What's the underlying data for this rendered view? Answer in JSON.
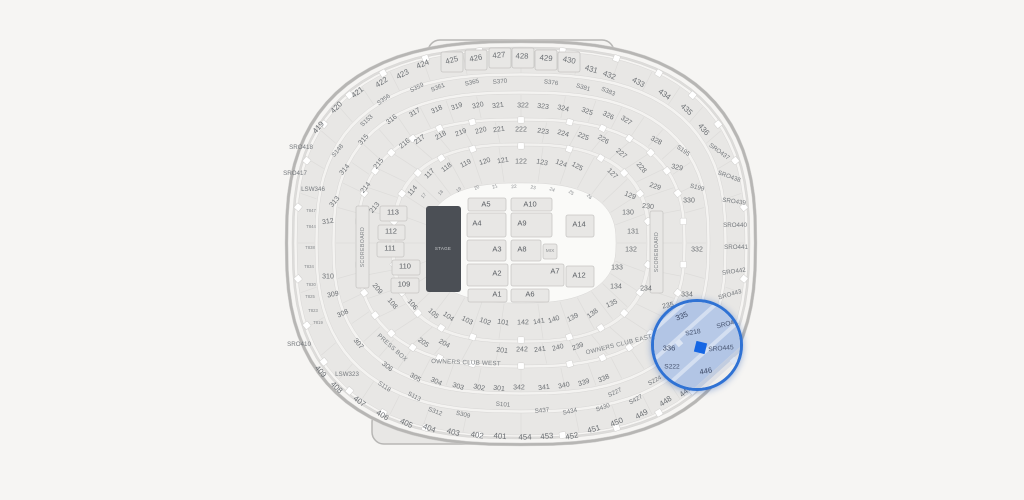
{
  "app": {
    "title": "Stadium seat map"
  },
  "colors": {
    "background": "#f6f5f3",
    "bowl": "#e8e7e5",
    "walkway": "#f4f3f1",
    "rim": "#b7b6b4",
    "section_line": "#dddcda",
    "box_stroke": "#c7c6c4",
    "floor": "#fafaf8",
    "stage_fill": "#4b4f55",
    "magnifier_ring": "#2f72d4",
    "magnifier_fill": "#b2c5e5",
    "selected": "#1566e4"
  },
  "map": {
    "labels": [
      [
        "419",
        319,
        128,
        "b"
      ],
      [
        "420",
        337,
        108,
        "b"
      ],
      [
        "421",
        358,
        93,
        "b"
      ],
      [
        "422",
        382,
        83,
        "b"
      ],
      [
        "423",
        403,
        75,
        "b"
      ],
      [
        "424",
        423,
        65,
        "b"
      ],
      [
        "425",
        452,
        61,
        "b"
      ],
      [
        "426",
        476,
        59,
        "b"
      ],
      [
        "427",
        499,
        56,
        "b"
      ],
      [
        "428",
        522,
        57,
        "b"
      ],
      [
        "429",
        546,
        59,
        "b"
      ],
      [
        "430",
        569,
        61,
        "b"
      ],
      [
        "431",
        591,
        70,
        "b"
      ],
      [
        "432",
        609,
        76,
        "b"
      ],
      [
        "433",
        638,
        83,
        "b"
      ],
      [
        "434",
        664,
        95,
        "b"
      ],
      [
        "435",
        686,
        110,
        "b"
      ],
      [
        "436",
        703,
        130,
        "b"
      ],
      [
        "409",
        320,
        372,
        "b"
      ],
      [
        "408",
        336,
        388,
        "b"
      ],
      [
        "407",
        359,
        402,
        "b"
      ],
      [
        "406",
        382,
        416,
        "b"
      ],
      [
        "405",
        406,
        424,
        "b"
      ],
      [
        "404",
        429,
        429,
        "b"
      ],
      [
        "403",
        453,
        433,
        "b"
      ],
      [
        "402",
        477,
        436,
        "b"
      ],
      [
        "401",
        500,
        437,
        "b"
      ],
      [
        "454",
        525,
        438,
        "b"
      ],
      [
        "453",
        547,
        437,
        "b"
      ],
      [
        "452",
        572,
        437,
        "b"
      ],
      [
        "451",
        594,
        430,
        "b"
      ],
      [
        "450",
        617,
        423,
        "b"
      ],
      [
        "449",
        642,
        415,
        "b"
      ],
      [
        "448",
        666,
        402,
        "b"
      ],
      [
        "447",
        686,
        392,
        "b"
      ],
      [
        "SRO418",
        301,
        148,
        "s",
        0
      ],
      [
        "SRO417",
        295,
        174,
        "s",
        0
      ],
      [
        "SRO410",
        299,
        345,
        "s",
        0
      ],
      [
        "LSW346",
        313,
        190,
        "s",
        0
      ],
      [
        "LSW323",
        347,
        375,
        "s",
        0
      ],
      [
        "SRO437",
        719,
        152,
        "s",
        36
      ],
      [
        "SRO438",
        729,
        177,
        "s",
        20
      ],
      [
        "SRO439",
        734,
        202,
        "s",
        8
      ],
      [
        "SRO440",
        735,
        226,
        "s",
        0
      ],
      [
        "SRO441",
        736,
        248,
        "s",
        0
      ],
      [
        "SRO442",
        734,
        272,
        "s",
        -8
      ],
      [
        "SRO443",
        730,
        295,
        "s",
        -16
      ],
      [
        "S356",
        384,
        100,
        "s"
      ],
      [
        "S359",
        417,
        88,
        "s"
      ],
      [
        "S361",
        438,
        88,
        "s"
      ],
      [
        "S365",
        472,
        83,
        "s"
      ],
      [
        "S370",
        500,
        82,
        "s"
      ],
      [
        "S376",
        551,
        83,
        "s"
      ],
      [
        "S381",
        583,
        88,
        "s"
      ],
      [
        "S383",
        608,
        92,
        "s"
      ],
      [
        "S153",
        367,
        121,
        "s"
      ],
      [
        "S148",
        338,
        151,
        "s"
      ],
      [
        "S195",
        683,
        151,
        "s",
        35
      ],
      [
        "S199",
        697,
        188,
        "s",
        15
      ],
      [
        "S118",
        384,
        387,
        "s"
      ],
      [
        "S113",
        414,
        397,
        "s"
      ],
      [
        "S101",
        503,
        405,
        "s"
      ],
      [
        "S312",
        435,
        412,
        "s"
      ],
      [
        "S309",
        463,
        415,
        "s"
      ],
      [
        "S437",
        542,
        411,
        "s"
      ],
      [
        "S434",
        570,
        412,
        "s"
      ],
      [
        "S430",
        603,
        408,
        "s"
      ],
      [
        "S427",
        636,
        400,
        "s"
      ],
      [
        "S227",
        615,
        393,
        "s"
      ],
      [
        "S224",
        655,
        381,
        "s",
        -28
      ],
      [
        "316",
        392,
        120
      ],
      [
        "317",
        415,
        113
      ],
      [
        "318",
        437,
        110
      ],
      [
        "319",
        457,
        107
      ],
      [
        "320",
        478,
        106
      ],
      [
        "321",
        498,
        106
      ],
      [
        "322",
        523,
        106
      ],
      [
        "323",
        543,
        107
      ],
      [
        "324",
        563,
        109
      ],
      [
        "325",
        587,
        112
      ],
      [
        "326",
        608,
        116
      ],
      [
        "327",
        626,
        121
      ],
      [
        "328",
        656,
        141,
        "",
        28
      ],
      [
        "329",
        677,
        168,
        "",
        12
      ],
      [
        "330",
        689,
        201,
        "",
        0
      ],
      [
        "332",
        697,
        250,
        "",
        0
      ],
      [
        "334",
        687,
        295,
        "",
        0
      ],
      [
        "315",
        364,
        140
      ],
      [
        "314",
        345,
        170
      ],
      [
        "313",
        335,
        202
      ],
      [
        "312",
        328,
        222,
        "",
        -8
      ],
      [
        "310",
        328,
        277,
        "",
        0
      ],
      [
        "309",
        333,
        295,
        "",
        -12
      ],
      [
        "308",
        343,
        314,
        "",
        -25
      ],
      [
        "307",
        358,
        344
      ],
      [
        "306",
        387,
        367
      ],
      [
        "305",
        415,
        378
      ],
      [
        "304",
        436,
        382
      ],
      [
        "303",
        458,
        387
      ],
      [
        "302",
        479,
        388
      ],
      [
        "301",
        499,
        389
      ],
      [
        "342",
        519,
        388
      ],
      [
        "341",
        544,
        388
      ],
      [
        "340",
        564,
        386
      ],
      [
        "339",
        584,
        383
      ],
      [
        "338",
        604,
        379
      ],
      [
        "215",
        379,
        164
      ],
      [
        "216",
        405,
        144
      ],
      [
        "217",
        420,
        140
      ],
      [
        "218",
        441,
        136
      ],
      [
        "219",
        461,
        133
      ],
      [
        "220",
        481,
        131
      ],
      [
        "221",
        499,
        130
      ],
      [
        "222",
        521,
        130
      ],
      [
        "223",
        543,
        132
      ],
      [
        "224",
        563,
        134
      ],
      [
        "225",
        583,
        137
      ],
      [
        "226",
        603,
        140
      ],
      [
        "227",
        621,
        154
      ],
      [
        "228",
        641,
        168
      ],
      [
        "229",
        655,
        187,
        "",
        18
      ],
      [
        "230",
        648,
        207,
        "",
        5
      ],
      [
        "214",
        366,
        188
      ],
      [
        "213",
        375,
        208
      ],
      [
        "209",
        377,
        289
      ],
      [
        "205",
        423,
        343
      ],
      [
        "204",
        444,
        344
      ],
      [
        "201",
        502,
        351
      ],
      [
        "242",
        522,
        350
      ],
      [
        "241",
        540,
        350
      ],
      [
        "240",
        558,
        348
      ],
      [
        "239",
        578,
        347
      ],
      [
        "234",
        646,
        289,
        "",
        0
      ],
      [
        "235",
        668,
        306,
        "",
        -12
      ],
      [
        "114",
        413,
        191
      ],
      [
        "117",
        430,
        174
      ],
      [
        "118",
        447,
        168
      ],
      [
        "119",
        466,
        164
      ],
      [
        "120",
        485,
        162
      ],
      [
        "121",
        503,
        161
      ],
      [
        "122",
        521,
        162
      ],
      [
        "123",
        542,
        163
      ],
      [
        "124",
        561,
        164
      ],
      [
        "125",
        577,
        167
      ],
      [
        "127",
        612,
        174
      ],
      [
        "129",
        630,
        196,
        "",
        22
      ],
      [
        "130",
        628,
        213,
        "",
        0
      ],
      [
        "131",
        633,
        232,
        "",
        0
      ],
      [
        "132",
        631,
        250,
        "",
        0
      ],
      [
        "133",
        617,
        268,
        "",
        0
      ],
      [
        "134",
        616,
        287,
        "",
        0
      ],
      [
        "135",
        612,
        304,
        "",
        -25
      ],
      [
        "138",
        593,
        314
      ],
      [
        "139",
        573,
        318
      ],
      [
        "140",
        554,
        320
      ],
      [
        "141",
        539,
        322
      ],
      [
        "142",
        523,
        323
      ],
      [
        "101",
        503,
        323
      ],
      [
        "102",
        485,
        322
      ],
      [
        "103",
        467,
        321
      ],
      [
        "104",
        448,
        317
      ],
      [
        "105",
        433,
        314
      ],
      [
        "106",
        412,
        305
      ],
      [
        "108",
        392,
        304
      ],
      [
        "17",
        424,
        196,
        "tiny"
      ],
      [
        "18",
        441,
        193,
        "tiny"
      ],
      [
        "19",
        459,
        190,
        "tiny"
      ],
      [
        "20",
        477,
        188,
        "tiny"
      ],
      [
        "21",
        495,
        187,
        "tiny"
      ],
      [
        "22",
        514,
        187,
        "tiny"
      ],
      [
        "23",
        533,
        188,
        "tiny"
      ],
      [
        "24",
        552,
        190,
        "tiny"
      ],
      [
        "25",
        571,
        193,
        "tiny"
      ],
      [
        "26",
        589,
        197,
        "tiny"
      ],
      [
        "T847",
        311,
        211,
        "t",
        0
      ],
      [
        "T844",
        311,
        227,
        "t",
        0
      ],
      [
        "T838",
        310,
        248,
        "t",
        0
      ],
      [
        "T834",
        309,
        267,
        "t",
        0
      ],
      [
        "T830",
        311,
        285,
        "t",
        0
      ],
      [
        "T825",
        310,
        297,
        "t",
        0
      ],
      [
        "T823",
        313,
        311,
        "t",
        0
      ],
      [
        "T819",
        318,
        323,
        "t",
        0
      ]
    ],
    "special_labels": [
      [
        "PRESS BOX",
        392,
        348,
        "area",
        42
      ],
      [
        "OWNERS CLUB WEST",
        466,
        363,
        "area",
        2
      ],
      [
        "OWNERS CLUB EAST",
        619,
        345,
        "area",
        -14
      ],
      [
        "SCOREBOARD",
        363,
        247,
        "sb",
        -90
      ],
      [
        "SCOREBOARD",
        657,
        252,
        "sb",
        -90
      ],
      [
        "STAGE",
        443,
        249,
        "stage",
        0
      ]
    ],
    "floor_sections": [
      [
        "A5",
        468,
        198,
        38,
        13,
        486,
        205
      ],
      [
        "A10",
        511,
        198,
        41,
        13,
        530,
        205
      ],
      [
        "A4",
        467,
        213,
        39,
        24,
        477,
        224
      ],
      [
        "A9",
        511,
        213,
        41,
        24,
        522,
        224
      ],
      [
        "A14",
        566,
        215,
        28,
        22,
        579,
        225
      ],
      [
        "A3",
        467,
        240,
        39,
        21,
        497,
        250
      ],
      [
        "A8",
        511,
        240,
        30,
        21,
        522,
        250
      ],
      [
        "MIX",
        543,
        244,
        14,
        15,
        550,
        251
      ],
      [
        "A2",
        467,
        264,
        41,
        22,
        497,
        274
      ],
      [
        "A7",
        511,
        264,
        53,
        22,
        555,
        272
      ],
      [
        "A12",
        566,
        266,
        28,
        21,
        579,
        276
      ],
      [
        "A1",
        468,
        289,
        39,
        13,
        497,
        295
      ],
      [
        "A6",
        511,
        289,
        38,
        13,
        530,
        295
      ]
    ],
    "side_boxes": [
      [
        "113",
        380,
        206,
        27,
        15,
        393,
        213
      ],
      [
        "112",
        378,
        225,
        27,
        15,
        391,
        232
      ],
      [
        "111",
        377,
        242,
        27,
        15,
        390,
        249
      ],
      [
        "110",
        392,
        260,
        28,
        15,
        405,
        267
      ],
      [
        "109",
        391,
        278,
        28,
        15,
        404,
        285
      ]
    ],
    "stage": {
      "x": 426,
      "y": 206,
      "w": 35,
      "h": 86
    },
    "scoreboards": [
      [
        356,
        206,
        13,
        82
      ],
      [
        650,
        211,
        13,
        82
      ]
    ],
    "top_section_boxes": [
      [
        441,
        52
      ],
      [
        465,
        50
      ],
      [
        489,
        48
      ],
      [
        512,
        48
      ],
      [
        535,
        50
      ],
      [
        558,
        52
      ]
    ],
    "magnifier": {
      "left": 651,
      "top": 299,
      "size": 92,
      "selected": {
        "x": 697,
        "y": 344,
        "size": 11,
        "rot": 14
      },
      "labels": [
        [
          "335",
          679,
          314,
          "",
          -22
        ],
        [
          "S218",
          690,
          330,
          "s",
          -10
        ],
        [
          "336",
          666,
          346,
          "",
          0
        ],
        [
          "SRO444",
          726,
          321,
          "s",
          -15
        ],
        [
          "SRO445",
          718,
          346,
          "s",
          -5
        ],
        [
          "446",
          703,
          369,
          "",
          -10
        ],
        [
          "S222",
          669,
          364,
          "s",
          0
        ]
      ],
      "entry_squares": [
        [
          22,
          38
        ],
        [
          77,
          56
        ]
      ]
    }
  }
}
